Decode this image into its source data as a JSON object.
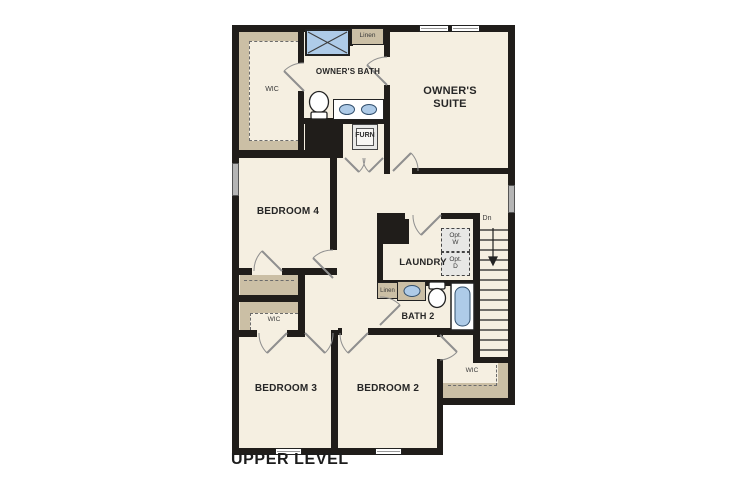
{
  "title": {
    "label": "UPPER LEVEL"
  },
  "colors": {
    "floor": "#f5efe1",
    "wall": "#201d1a",
    "shelf": "#cbbfa5",
    "fixture": "#aecbe8",
    "swing": "#8f8f8f",
    "dash": "#6b6b6b",
    "opt_fill": "#e7e7e5"
  },
  "rooms": {
    "owners_suite": {
      "label": "OWNER'S SUITE"
    },
    "owners_bath": {
      "label": "OWNER'S BATH"
    },
    "owners_wic": {
      "label": "WIC"
    },
    "linen_upper": {
      "label": "Linen"
    },
    "furnace": {
      "label": "FURN"
    },
    "bedroom4": {
      "label": "BEDROOM 4"
    },
    "laundry": {
      "label": "LAUNDRY"
    },
    "opt_washer": {
      "line1": "Opt.",
      "line2": "W"
    },
    "opt_dryer": {
      "line1": "Opt.",
      "line2": "D"
    },
    "stairs": {
      "label": "Dn"
    },
    "linen_hall": {
      "label": "Linen"
    },
    "bath2": {
      "label": "BATH 2"
    },
    "bedroom3_wic": {
      "label": "WIC"
    },
    "bedroom3": {
      "label": "BEDROOM 3"
    },
    "bedroom2": {
      "label": "BEDROOM 2"
    },
    "bedroom2_wic": {
      "label": "WIC"
    }
  }
}
